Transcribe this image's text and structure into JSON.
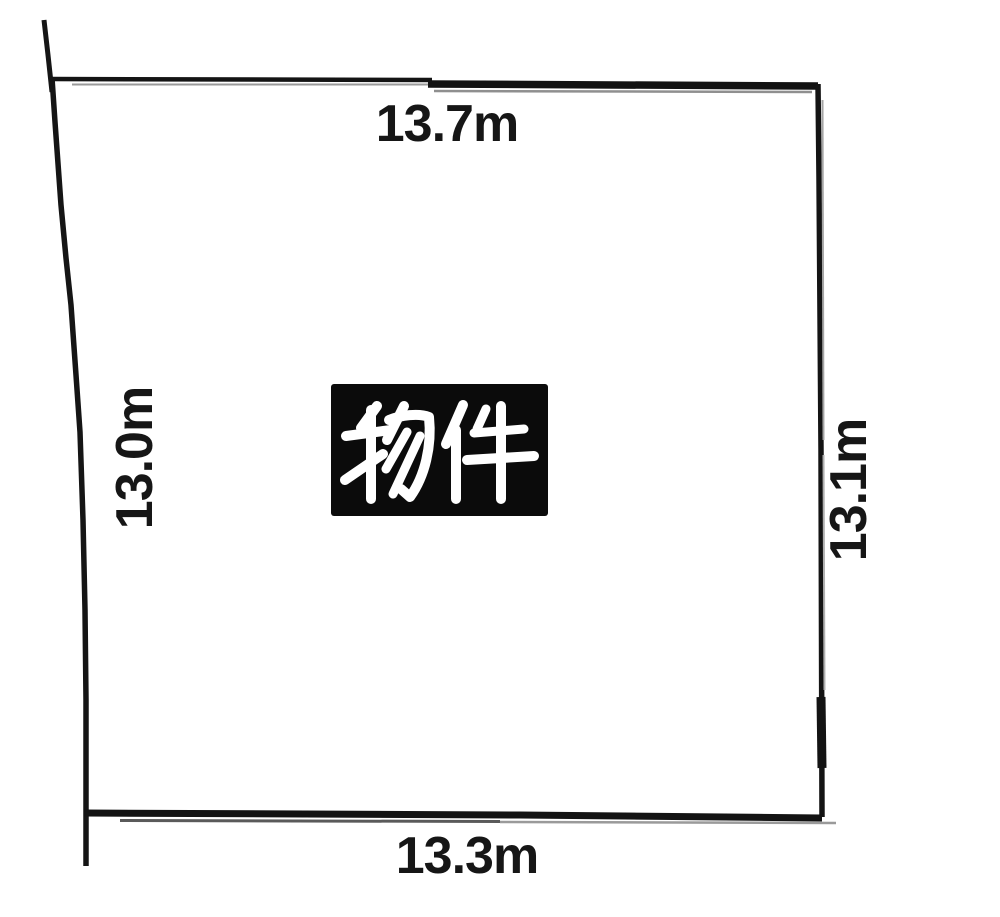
{
  "diagram": {
    "property_label": "物件",
    "dimensions": {
      "top": "13.7m",
      "right": "13.1m",
      "bottom": "13.3m",
      "left": "13.0m"
    },
    "sides": [
      {
        "side": "top",
        "length_m": 13.7,
        "label": "13.7m"
      },
      {
        "side": "right",
        "length_m": 13.1,
        "label": "13.1m"
      },
      {
        "side": "bottom",
        "length_m": 13.3,
        "label": "13.3m"
      },
      {
        "side": "left",
        "length_m": 13.0,
        "label": "13.0m"
      }
    ],
    "colors": {
      "background": "#ffffff",
      "line": "#151515",
      "line_shadow": "#9a9a9a",
      "badge_background": "#0b0b0b",
      "badge_text": "#ffffff",
      "dimension_text": "#161616"
    }
  }
}
